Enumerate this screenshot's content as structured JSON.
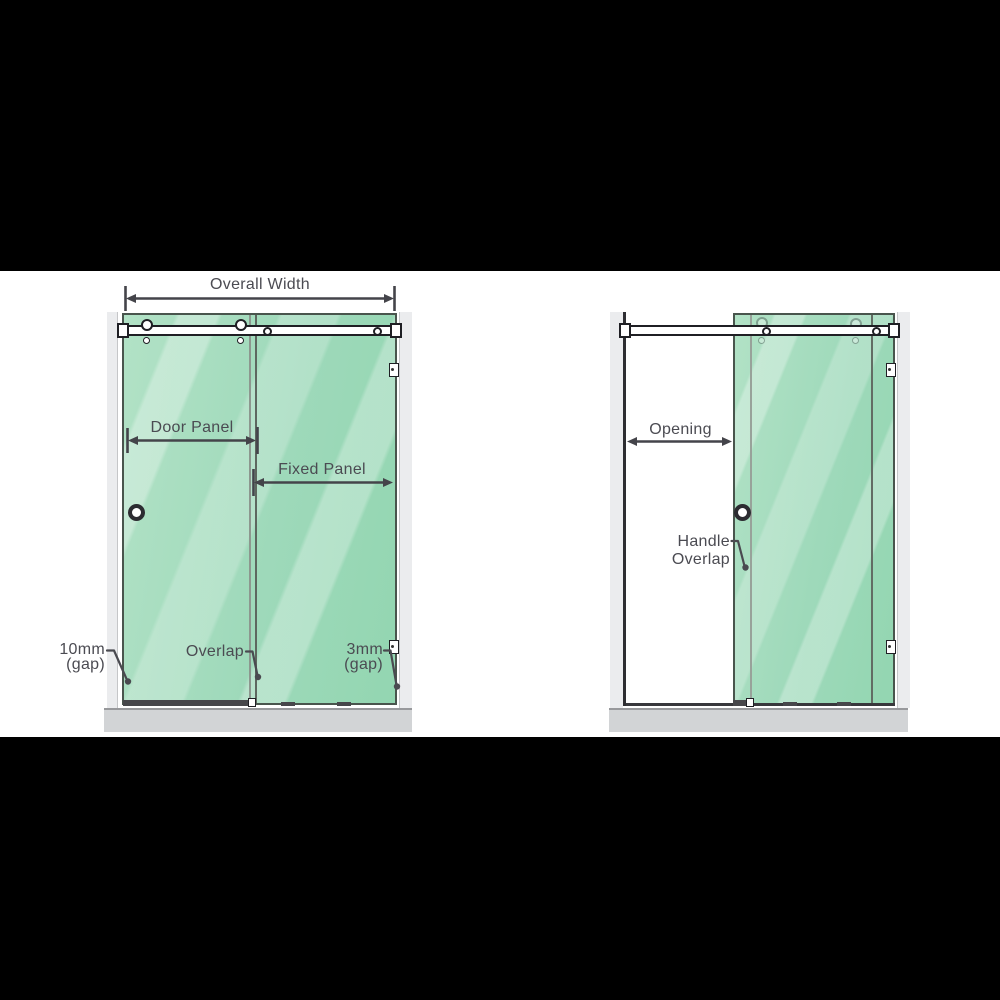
{
  "colors": {
    "glass": "#a4dcbc",
    "glass_edge": "#49554d",
    "wall": "#ebecee",
    "tray": "#d2d4d6",
    "label_text": "#4b4b52",
    "arrow": "#44444a",
    "hardware": "#1f1f24",
    "letterbox": "#000000",
    "band": "#ffffff"
  },
  "closed": {
    "overall_width": "Overall Width",
    "door_panel": "Door Panel",
    "fixed_panel": "Fixed Panel",
    "overlap": "Overlap",
    "gap_left": [
      "10mm",
      "(gap)"
    ],
    "gap_right": [
      "3mm",
      "(gap)"
    ]
  },
  "open": {
    "opening": "Opening",
    "handle_overlap": [
      "Handle",
      "Overlap"
    ]
  }
}
